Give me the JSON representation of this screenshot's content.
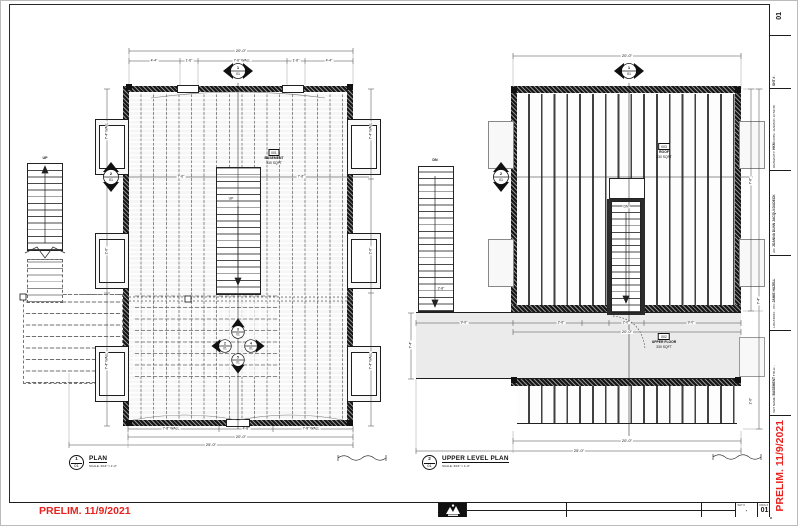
{
  "page": {
    "prelim_note": "PRELIM. 11/9/2021",
    "colors": {
      "prelim_red": "#e8231f",
      "band_gray": "#ebebeb",
      "line": "#1d1d1d"
    }
  },
  "titleblock": {
    "set_name_label": "SET NAME:",
    "set_name_value": "BASEMENT",
    "title_label": "TITLE:",
    "title_value": "-",
    "location_label": "LOCATION:",
    "location_value": "-",
    "po_label": "PO:",
    "po_value": "JAMIE HAZELL",
    "ad_label": "AD:",
    "ad_value_1": "JOANNA DUNN",
    "ad_value_2": "JACQUI DUDECK",
    "drawn_by_label": "DRAWN BY:",
    "drawn_by_value": "HKM",
    "date_label": "DATE:",
    "date_value": "11/9/2021 10:52:38",
    "sht_label": "SHT #",
    "sht_value": "-",
    "dwg_label": "DWG #",
    "dwg_value": "01"
  },
  "plan1": {
    "callout": {
      "number": "1",
      "sheet": "01"
    },
    "title": "PLAN",
    "scale_note": "SCALE: 3/16\" = 1'-0\"",
    "room_tag": {
      "id": "001",
      "name": "BASEMENT",
      "area": "330 SQFT"
    },
    "stair_up_label": "UP",
    "center_stair_label": "UP",
    "dims": {
      "top_overall": "20'-0\"",
      "top_segments": [
        "4'-4\"",
        "1'-6\"",
        "7'-6\" WALL",
        "1'-6\"",
        "4'-4\""
      ],
      "cut_segments": [
        "7'-6\"",
        "7'-6\""
      ],
      "side_left": [
        "7'-4\" WALL",
        "2'-6\"",
        "7'-4\" WALL"
      ],
      "side_right": [
        "7'-4\" WALL",
        "2'-6\"",
        "7'-4\" WALL"
      ],
      "bottom_segments": [
        "7'-8\" WALL",
        "4'-8\"",
        "7'-8\" WALL"
      ],
      "bottom_overall": "20'-0\"",
      "bottom_total": "25'-0\""
    },
    "markers": {
      "top": {
        "number": "1",
        "sheet": "01"
      },
      "left": {
        "number": "2",
        "sheet": "01"
      },
      "cluster": [
        {
          "number": "3",
          "sheet": "01"
        },
        {
          "number": "2",
          "sheet": "01"
        },
        {
          "number": "4",
          "sheet": "01"
        },
        {
          "number": "5",
          "sheet": "01"
        }
      ]
    }
  },
  "plan2": {
    "callout": {
      "number": "2",
      "sheet": "01"
    },
    "title": "UPPER LEVEL PLAN",
    "scale_note": "SCALE: 3/16\" = 1'-0\"",
    "room_tag": {
      "id": "002",
      "name": "UPPER FLOOR",
      "area": "330 SQFT"
    },
    "upper_tag": {
      "id": "003",
      "name": "ROOF",
      "area": "330 SQFT"
    },
    "stair_dn_label": "DN",
    "center_stair_label": "DN",
    "dims": {
      "top_overall": "20'-0\"",
      "mid_segments": [
        "9'-0\"",
        "2'-6\"",
        "2'-0\"",
        "9'-0\""
      ],
      "mid_overall": "20'-0\"",
      "side_left": [
        "2'-8\"",
        "7'-4\""
      ],
      "side_right": [
        "7'-6\"",
        "7'-4\"",
        "2'-6\""
      ],
      "bottom_overall": "20'-0\"",
      "bottom_total": "25'-0\""
    },
    "markers": {
      "top": {
        "number": "1",
        "sheet": "01"
      },
      "left": {
        "number": "2",
        "sheet": "01"
      }
    }
  }
}
